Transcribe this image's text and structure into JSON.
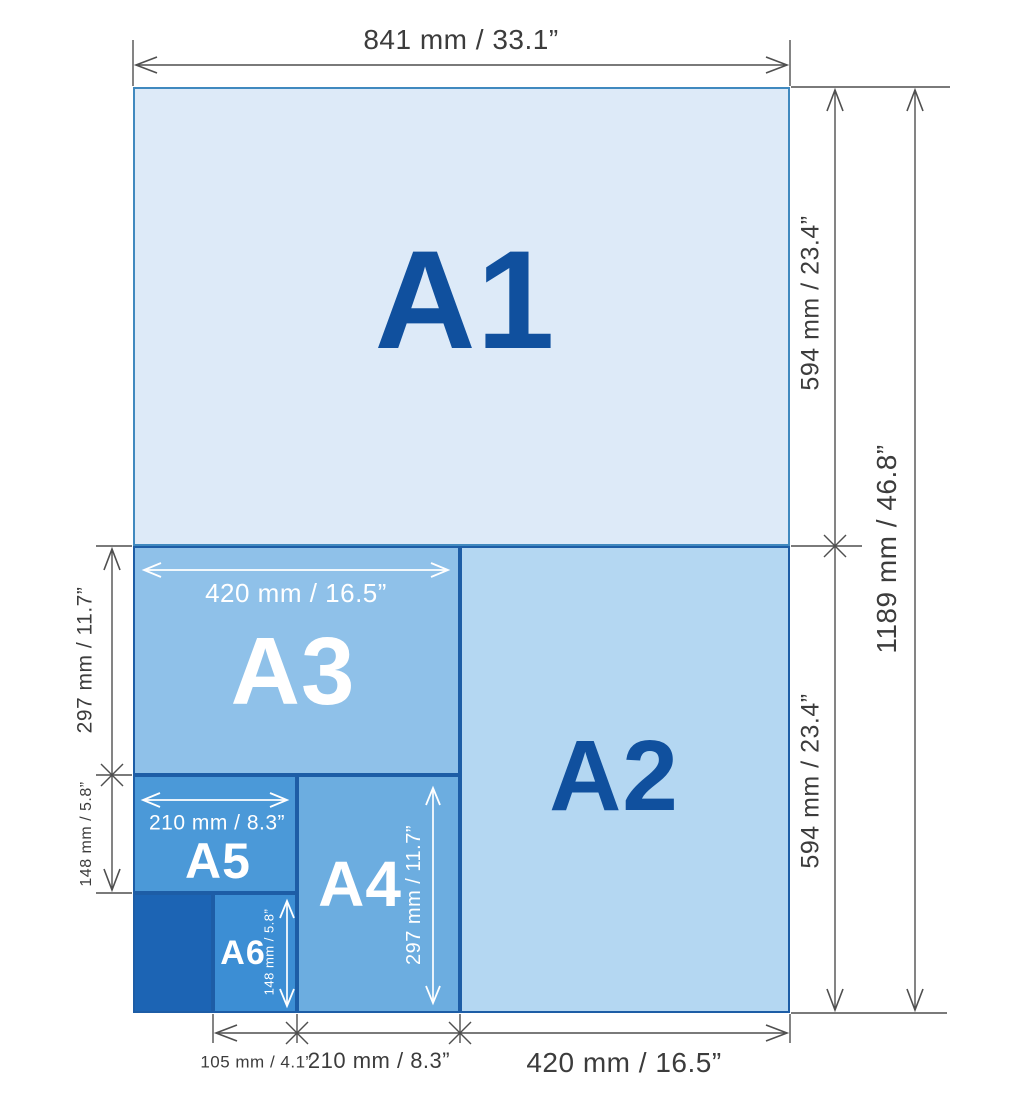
{
  "sheets": {
    "a1": {
      "label": "A1"
    },
    "a2": {
      "label": "A2"
    },
    "a3": {
      "label": "A3",
      "width_label": "420 mm / 16.5”"
    },
    "a4": {
      "label": "A4",
      "height_label": "297 mm / 11.7”"
    },
    "a5": {
      "label": "A5",
      "width_label": "210 mm / 8.3”"
    },
    "a6": {
      "label": "A6",
      "height_label": "148 mm / 5.8”"
    }
  },
  "dimensions": {
    "top_width": "841 mm / 33.1”",
    "right_upper": "594 mm / 23.4”",
    "right_lower": "594 mm / 23.4”",
    "right_total": "1189 mm / 46.8”",
    "left_upper": "297 mm / 11.7”",
    "left_lower": "148 mm / 5.8”",
    "bottom_left": "105 mm / 4.1”",
    "bottom_middle": "210 mm / 8.3”",
    "bottom_right": "420 mm / 16.5”"
  },
  "colors": {
    "a1_fill": "#ddeaf8",
    "a2_fill": "#b4d7f2",
    "a3_fill": "#8fc1e9",
    "a4_fill": "#6cade0",
    "a5_fill": "#4b99d8",
    "a6_fill": "#3c8ed4",
    "small_sizes_fill": "#1c64b4",
    "sheet_border": "#1d5da6",
    "label_dark_blue": "#10509e",
    "label_white": "#ffffff",
    "dimension_text": "#3c3c3c",
    "dimension_line": "#4f4f4f"
  }
}
